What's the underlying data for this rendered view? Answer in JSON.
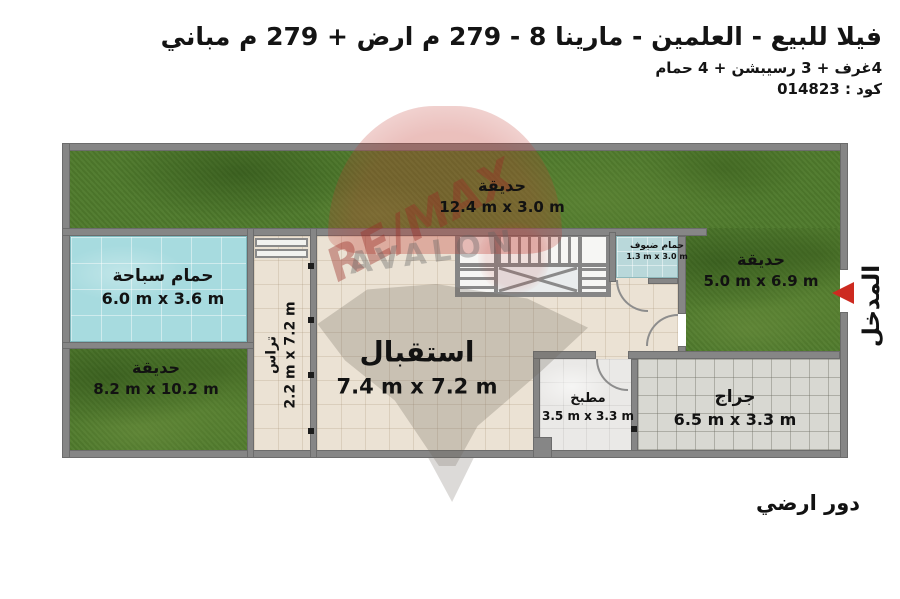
{
  "header": {
    "title": "فيلا للبيع - العلمين - مارينا 8 - 279 م ارض + 279 م مباني",
    "subtitle": "4غرف + 3 رسيبشن + 4 حمام",
    "code": "كود : 014823"
  },
  "rooms": {
    "garden_top": {
      "name": "حديقة",
      "dims": "12.4 m x 3.0 m"
    },
    "pool": {
      "name": "حمام سباحة",
      "dims": "6.0 m x 3.6 m"
    },
    "garden_left": {
      "name": "حديقة",
      "dims": "8.2 m x 10.2 m"
    },
    "terrace": {
      "name": "تراس",
      "dims": "2.2 m x 7.2 m"
    },
    "reception": {
      "name": "استقبال",
      "dims": "7.4 m x 7.2 m"
    },
    "guest_bath": {
      "name": "حمام ضيوف",
      "dims": "1.3 m x 3.0 m"
    },
    "garden_right": {
      "name": "حديقة",
      "dims": "5.0 m x 6.9 m"
    },
    "kitchen": {
      "name": "مطبخ",
      "dims": "3.5 m x 3.3 m"
    },
    "garage": {
      "name": "جراج",
      "dims": "6.5 m x 3.3 m"
    }
  },
  "entrance_label": "المدخل",
  "floor_label": "دور ارضي",
  "watermark": {
    "line1": "RE/MAX",
    "line2": "AVALON"
  },
  "colors": {
    "grass": "#4f7a2c",
    "pool": "#a7dbdf",
    "floor": "#ebe2d4",
    "garage_floor": "#d8d8d2",
    "wall": "#868686",
    "accent_red": "#cd2a20"
  }
}
